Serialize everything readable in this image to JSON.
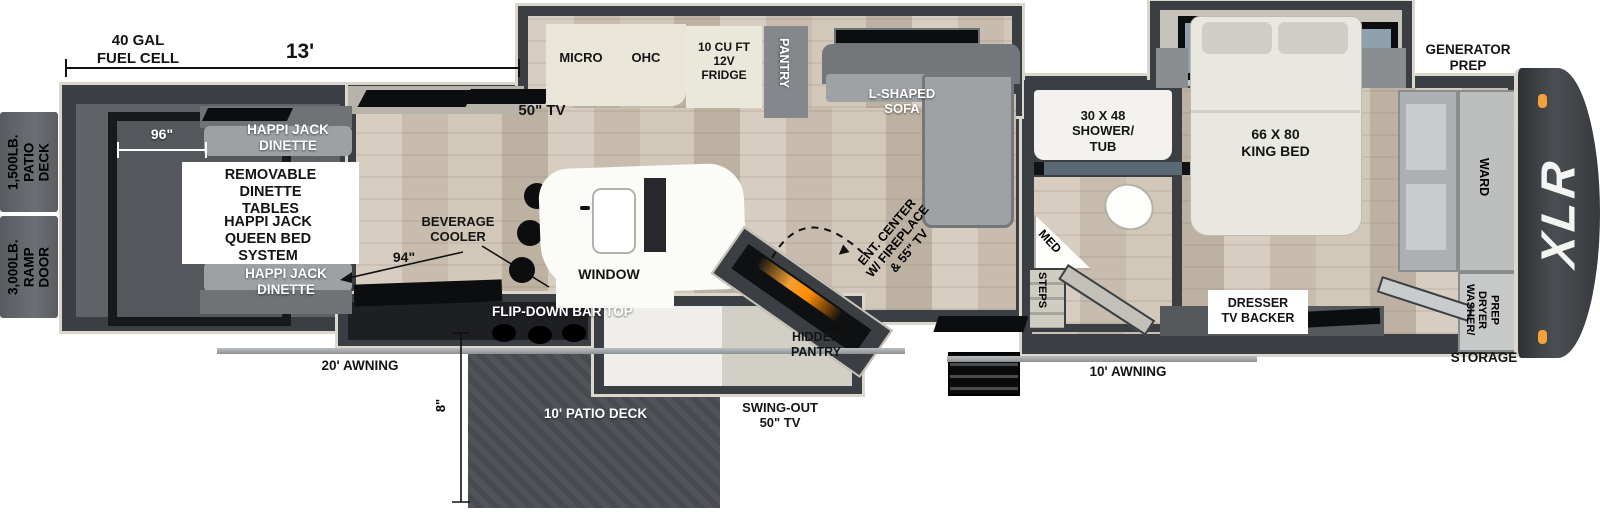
{
  "floorplan": {
    "brand_logo": "XLR",
    "colors": {
      "wall": "#3b3f43",
      "exterior_trim": "#dcd7cb",
      "wood_floor": "#cfc5b7",
      "garage_floor": "#5f6367",
      "patio_deck": "#4b4f54",
      "fireplace_glow": "#f5a02d",
      "marker_light": "#f2a23a"
    },
    "dimensions": {
      "garage_length": "13'",
      "fuel_cell": "40 GAL\nFUEL CELL",
      "garage_width": "96\"",
      "bar_wall": "94\"",
      "deck_drop": "8\"",
      "awning_rear": "20' AWNING",
      "awning_front": "10' AWNING"
    },
    "capacities": {
      "patio_deck": "1,500LB.\nPATIO DECK",
      "ramp_door": "3,000LB.\nRAMP DOOR"
    },
    "garage": {
      "dinette_top": "HAPPI JACK\nDINETTE",
      "dinette_bottom": "HAPPI JACK\nDINETTE",
      "info_tables": "REMOVABLE\nDINETTE\nTABLES",
      "info_bed": "HAPPI JACK\nQUEEN BED\nSYSTEM",
      "tv": "50\" TV"
    },
    "kitchen": {
      "micro": "MICRO",
      "ohc": "OHC",
      "fridge": "10 CU FT\n12V\nFRIDGE",
      "pantry": "PANTRY",
      "sofa": "L-SHAPED\nSOFA",
      "beverage_cooler": "BEVERAGE\nCOOLER",
      "window": "WINDOW",
      "flip_bar": "FLIP-DOWN BAR TOP",
      "patio_deck": "10' PATIO DECK",
      "swing_tv": "SWING-OUT\n50\" TV",
      "hidden_pantry": "HIDDEN\nPANTRY",
      "ent_center": "ENT. CENTER\nW/ FIREPLACE\n& 55\" TV",
      "pointer": "▶"
    },
    "bath": {
      "shower": "30 X 48\nSHOWER/\nTUB",
      "med": "MED",
      "steps": "STEPS"
    },
    "bedroom": {
      "bed": "66 X 80\nKING BED",
      "generator": "GENERATOR\nPREP",
      "dresser": "DRESSER\nTV BACKER",
      "ward": "WARD",
      "washer_dryer": "WASHER/\nDRYER\nPREP",
      "storage": "STORAGE"
    }
  }
}
